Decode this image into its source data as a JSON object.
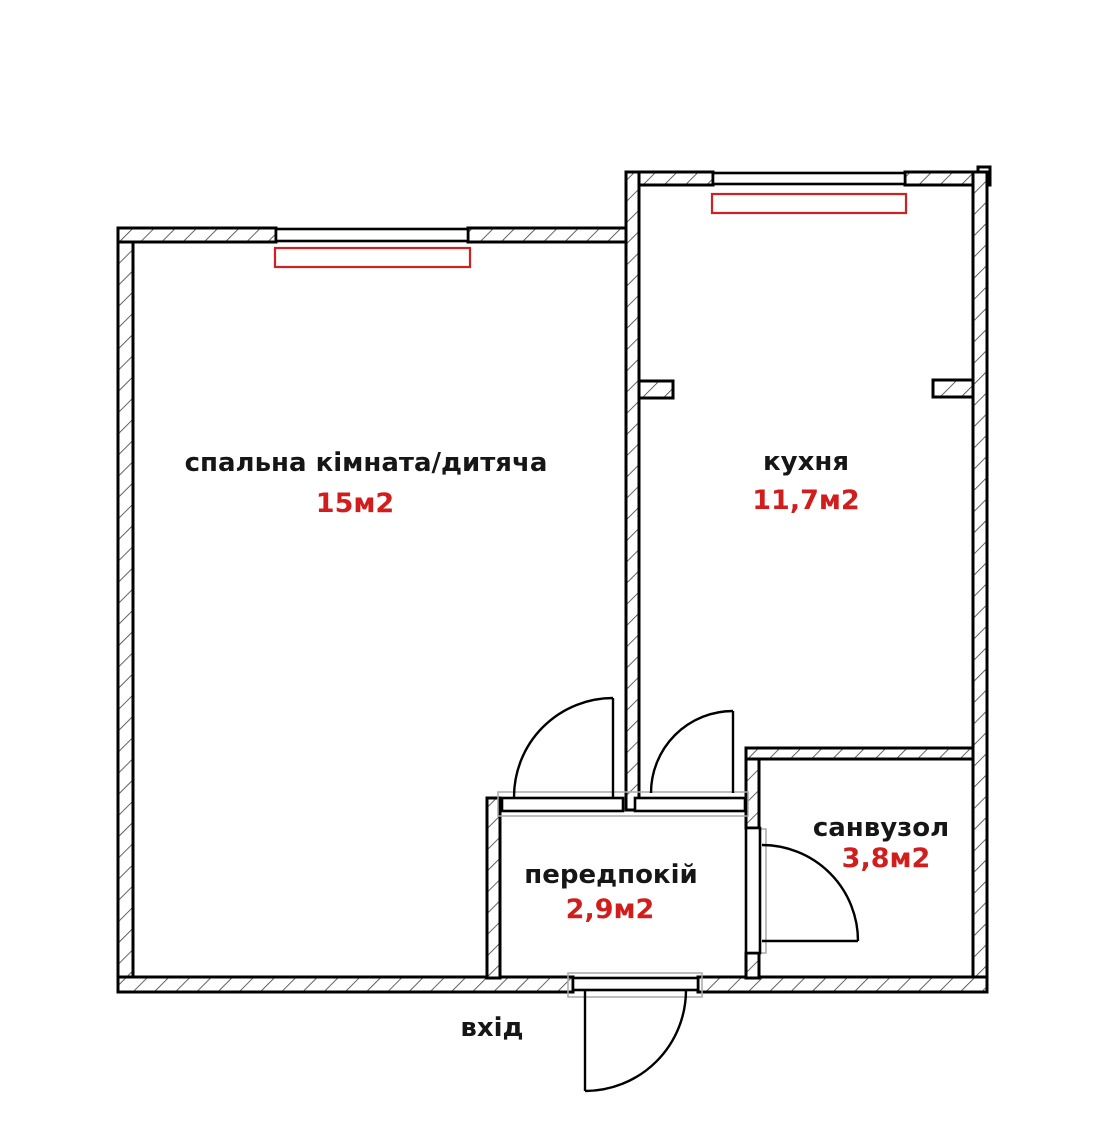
{
  "plan": {
    "rooms": [
      {
        "id": "bedroom",
        "label": "спальна кімната/дитяча",
        "area": "15м2"
      },
      {
        "id": "kitchen",
        "label": "кухня",
        "area": "11,7м2"
      },
      {
        "id": "hallway",
        "label": "передпокій",
        "area": "2,9м2"
      },
      {
        "id": "bathroom",
        "label": "санвузол",
        "area": "3,8м2"
      }
    ],
    "entrance_label": "вхід",
    "colors": {
      "label_text": "#161616",
      "area_text": "#d21d1d",
      "radiator": "#cf2121",
      "wall_line": "#000000",
      "hatch_line": "#3c3c3c",
      "casing": "#a9a9a9"
    }
  }
}
